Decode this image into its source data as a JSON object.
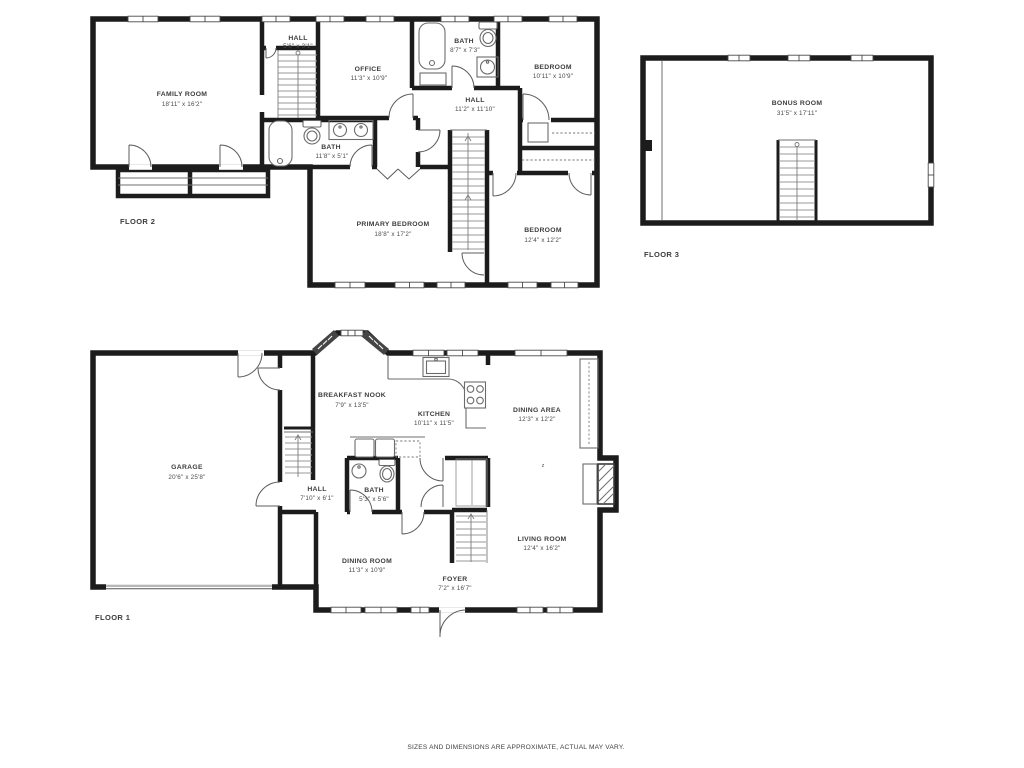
{
  "colors": {
    "wall": "#1c1c1c",
    "fixture": "#6b6b6b",
    "stair": "#9a9a9a",
    "text": "#3c3c3c",
    "background": "#ffffff"
  },
  "disclaimer": "SIZES AND DIMENSIONS ARE APPROXIMATE, ACTUAL MAY VARY.",
  "marker": "z",
  "floors": [
    {
      "label": "FLOOR 2",
      "rooms": [
        {
          "name": "FAMILY ROOM",
          "dims": "18'11\" x 16'2\""
        },
        {
          "name": "HALL",
          "dims": "5'6\" x 3'1\""
        },
        {
          "name": "OFFICE",
          "dims": "11'3\" x 10'9\""
        },
        {
          "name": "BATH",
          "dims": "8'7\" x 7'3\""
        },
        {
          "name": "BEDROOM",
          "dims": "10'11\" x 10'9\""
        },
        {
          "name": "HALL",
          "dims": "11'2\" x 11'10\""
        },
        {
          "name": "BATH",
          "dims": "11'8\" x 5'1\""
        },
        {
          "name": "PRIMARY BEDROOM",
          "dims": "18'8\" x 17'2\""
        },
        {
          "name": "BEDROOM",
          "dims": "12'4\" x 12'2\""
        }
      ]
    },
    {
      "label": "FLOOR 3",
      "rooms": [
        {
          "name": "BONUS ROOM",
          "dims": "31'5\" x 17'11\""
        }
      ]
    },
    {
      "label": "FLOOR 1",
      "rooms": [
        {
          "name": "GARAGE",
          "dims": "20'6\" x 25'8\""
        },
        {
          "name": "BREAKFAST NOOK",
          "dims": "7'9\" x 13'5\""
        },
        {
          "name": "KITCHEN",
          "dims": "10'11\" x 11'5\""
        },
        {
          "name": "DINING AREA",
          "dims": "12'3\" x 12'2\""
        },
        {
          "name": "HALL",
          "dims": "7'10\" x 6'1\""
        },
        {
          "name": "BATH",
          "dims": "5'3\" x 5'6\""
        },
        {
          "name": "DINING ROOM",
          "dims": "11'3\" x 10'9\""
        },
        {
          "name": "FOYER",
          "dims": "7'2\" x 16'7\""
        },
        {
          "name": "LIVING ROOM",
          "dims": "12'4\" x 16'2\""
        }
      ]
    }
  ]
}
